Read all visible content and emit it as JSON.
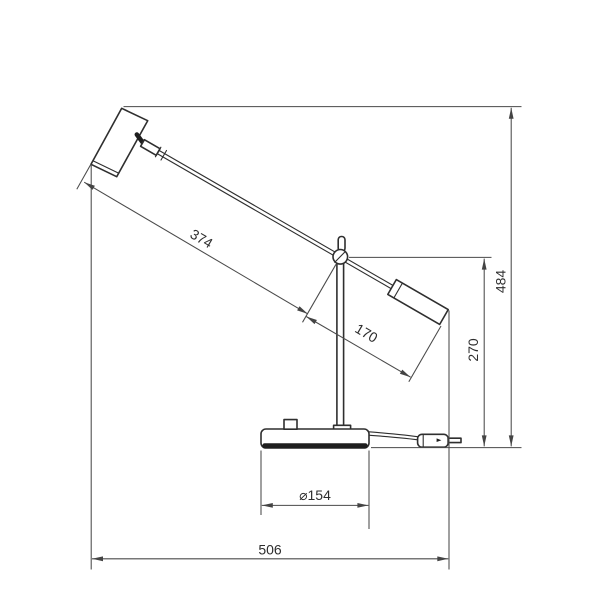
{
  "drawing": {
    "labels": {
      "front_arm_length": "374",
      "rear_arm_length": "170",
      "total_height": "484",
      "pivot_height": "270",
      "base_diameter": "⌀154",
      "overall_length": "506"
    },
    "colors": {
      "background": "#ffffff",
      "outline": "#2f2f2f",
      "dimension": "#4a4a4a",
      "text": "#2e2e2e"
    }
  }
}
